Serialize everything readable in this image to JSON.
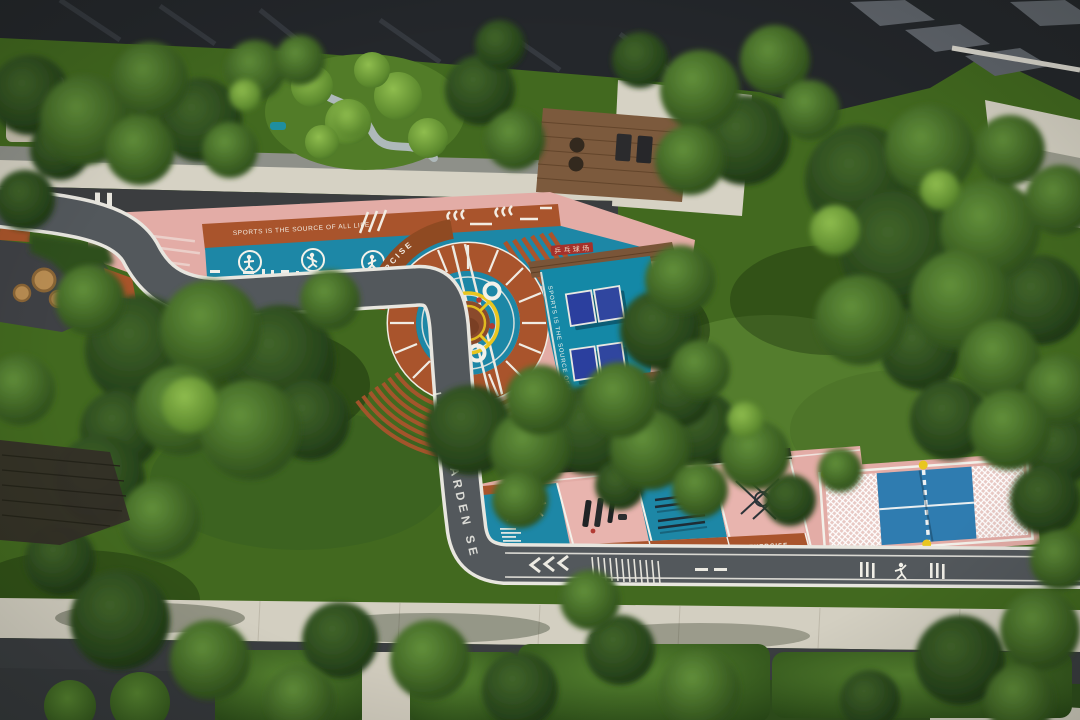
{
  "scene": {
    "title": "Aerial view of residential fitness garden and sports courts"
  },
  "texts": {
    "slogan_band": "SPORTS IS THE SOURCE OF ALL LIFE",
    "slogan_curve": "SPORTS IS THE SOURCE OF ALL LIFE",
    "slogan_pingpong": "SPORTS IS THE SOURCE OF ALL LIFE",
    "exercise_badge": "EXERCISE",
    "exercise_band_1": "EXERCISE",
    "exercise_band_2": "EXERCISE",
    "exercise_band_3": "EXERCISE",
    "path_name": "LIGHT GARDEN SEN BAY",
    "deck_sign": "乒乓球场"
  },
  "icons": [
    {
      "name": "exercise-figure-icon",
      "desc": "white stick figure in circle"
    },
    {
      "name": "runner-icon",
      "desc": "white running person on track"
    }
  ],
  "colors": {
    "lawn": "#42691f",
    "tree_dark": "#24421c",
    "pink_pavement": "#e3aca6",
    "terracotta": "#a9542c",
    "sports_blue": "#1d87a6",
    "table_navy": "#2b3f9e",
    "court_blue": "#2f7cb0",
    "post_yellow": "#e9c61f",
    "path_gray": "#53585c",
    "concrete": "#d6d2c4",
    "building_dark": "#24272b",
    "line_white": "#f0ece4"
  }
}
